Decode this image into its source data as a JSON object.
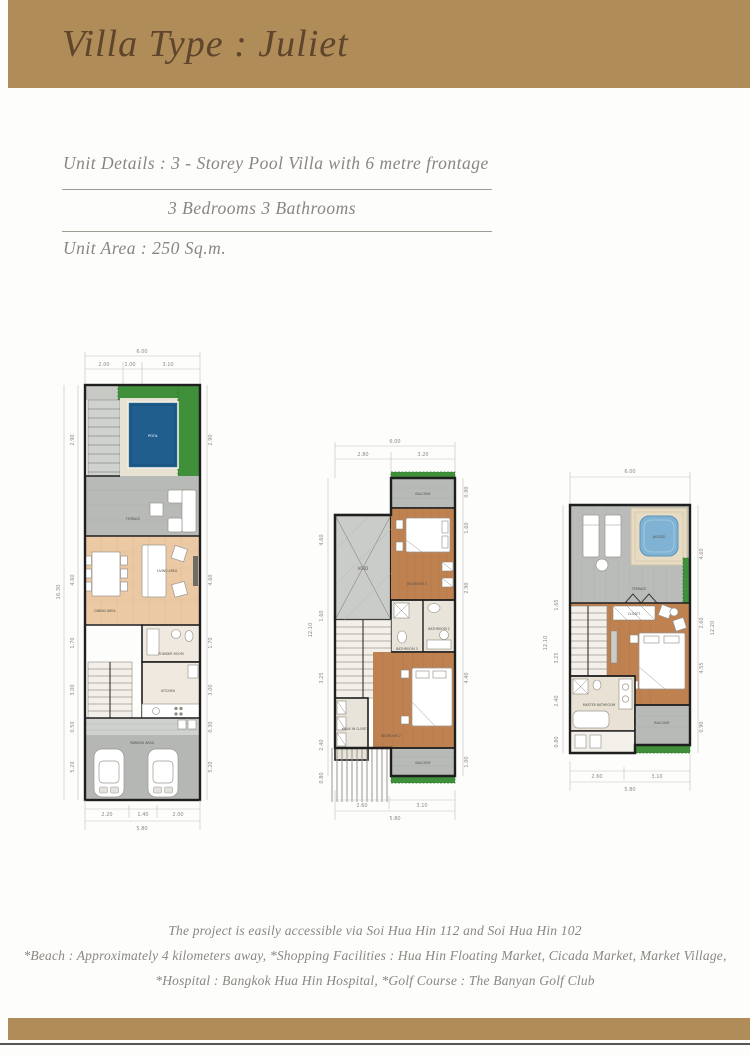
{
  "header": {
    "title": "Villa Type : Juliet"
  },
  "details": {
    "unit_details": "Unit  Details  :  3 - Storey Pool Villa with 6 metre frontage",
    "rooms": "3 Bedrooms  3 Bathrooms",
    "unit_area": "Unit Area   :  250 Sq.m."
  },
  "plans": [
    {
      "id": "ground-floor",
      "dims": {
        "top_total": "6.00",
        "top": [
          "2.00",
          "1.00",
          "3.10"
        ],
        "left_total": "16.30",
        "left": [
          "2.90",
          "4.60",
          "1.70",
          "3.00",
          "0.50",
          "5.20"
        ],
        "right": [
          "2.90",
          "4.60",
          "1.70",
          "3.00",
          "0.30",
          "5.20"
        ],
        "bottom": [
          "2.20",
          "1.40",
          "2.00"
        ],
        "bottom_total": "5.80"
      },
      "labels": {
        "garden": "GARDEN",
        "pool": "POOL",
        "terrace": "TERRACE",
        "living": "LIVING AREA",
        "dining": "DINING AREA",
        "powder": "POWDER ROOM",
        "kitchen": "KITCHEN",
        "parking": "PARKING AREA"
      }
    },
    {
      "id": "second-floor",
      "dims": {
        "top_total": "6.00",
        "top": [
          "2.80",
          "3.20"
        ],
        "left_total": "12.10",
        "left": [
          "4.60",
          "1.60",
          "3.25",
          "2.40",
          "0.80"
        ],
        "right": [
          "0.90",
          "1.60",
          "2.90",
          "4.40",
          "1.00"
        ],
        "bottom": [
          "2.60",
          "3.10"
        ],
        "bottom_total": "5.80"
      },
      "labels": {
        "void": "VOID",
        "balcony_top": "BALCONY",
        "bedroom3": "BEDROOM 3",
        "bathroom3": "BATHROOM 3",
        "bathroom2": "BATHROOM 2",
        "bedroom2": "BEDROOM 2",
        "closet": "WALK IN CLOSET",
        "balcony_bottom": "BALCONY"
      }
    },
    {
      "id": "third-floor",
      "dims": {
        "top_total": "6.00",
        "left_total": "12.10",
        "left": [
          "1.65",
          "3.25",
          "2.40",
          "0.80"
        ],
        "right_total": "12.20",
        "right": [
          "4.60",
          "2.60",
          "4.55",
          "0.90"
        ],
        "bottom": [
          "2.60",
          "3.10"
        ],
        "bottom_total": "5.80"
      },
      "labels": {
        "jacuzzi": "JACUZZI",
        "terrace": "TERRACE",
        "closet": "CLOSET",
        "master_bedroom": "MASTER BEDROOM",
        "master_bathroom": "MASTER BATHROOM",
        "balcony": "BALCONY"
      }
    }
  ],
  "footer": {
    "line1": "The project is easily accessible via Soi Hua Hin 112 and Soi Hua Hin 102",
    "line2": "*Beach : Approximately  4 kilometers away,  *Shopping Facilities : Hua Hin Floating Market, Cicada Market, Market Village,",
    "line3": "*Hospital : Bangkok Hua Hin Hospital,  *Golf Course : The Banyan Golf Club"
  },
  "palette": {
    "gold": "#b08c59",
    "title_brown": "#5e452c",
    "text_gray": "#8a8580",
    "pool_blue": "#205e8e",
    "jacuzzi_blue": "#7fb2d3",
    "hedge_green": "#3f8f3b",
    "wood_floor": "#bf8150",
    "tile_floor": "#eac9a4",
    "terrace_gray": "#b7bab6"
  }
}
